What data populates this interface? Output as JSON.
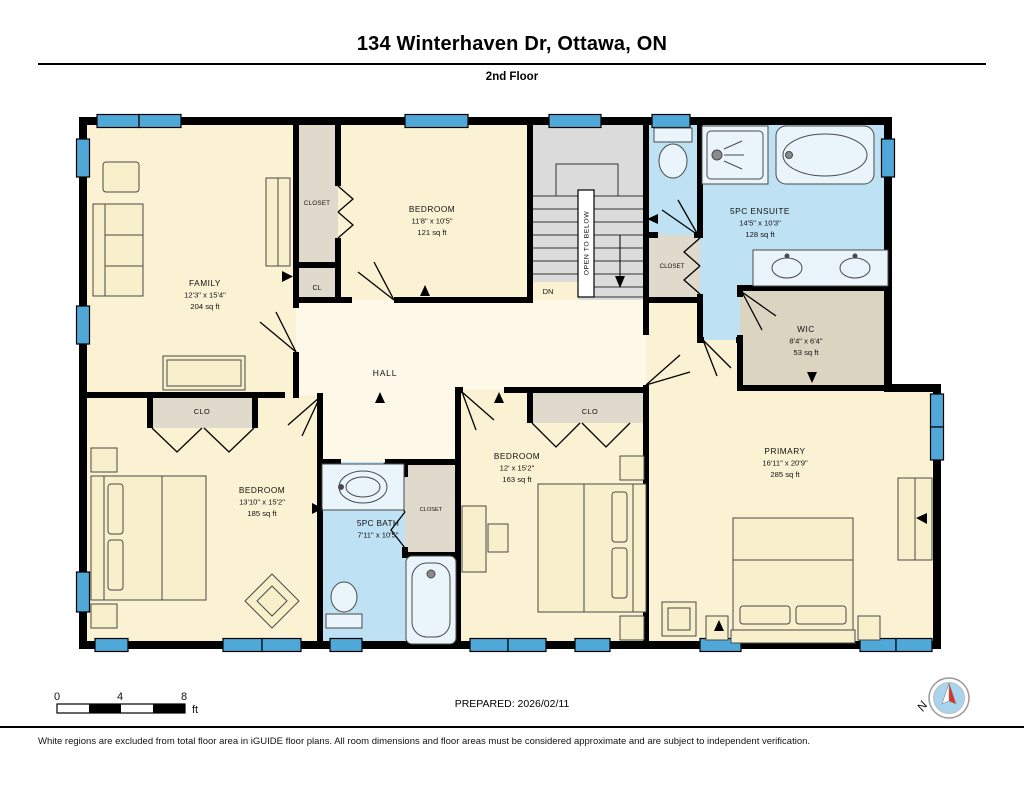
{
  "header": {
    "title": "134 Winterhaven Dr, Ottawa, ON",
    "floor": "2nd Floor"
  },
  "rooms": {
    "family": {
      "name": "FAMILY",
      "dims": "12'3\" x 15'4\"",
      "area": "204 sq ft"
    },
    "closet_top": {
      "name": "CLOSET"
    },
    "cl": {
      "name": "CL"
    },
    "bedroom_top": {
      "name": "BEDROOM",
      "dims": "11'8\" x 10'5\"",
      "area": "121 sq ft"
    },
    "stairs": {
      "open_to_below": "OPEN TO BELOW",
      "dn": "DN"
    },
    "closet_mid": {
      "name": "CLOSET"
    },
    "ensuite": {
      "name": "5PC ENSUITE",
      "dims": "14'5\" x 10'3\"",
      "area": "128 sq ft"
    },
    "wic": {
      "name": "WIC",
      "dims": "8'4\" x 6'4\"",
      "area": "53 sq ft"
    },
    "hall": {
      "name": "HALL"
    },
    "clo_left": {
      "name": "CLO"
    },
    "clo_right": {
      "name": "CLO"
    },
    "bedroom_left": {
      "name": "BEDROOM",
      "dims": "13'10\" x 15'2\"",
      "area": "185 sq ft"
    },
    "bath": {
      "name": "5PC BATH",
      "dims": "7'11\" x 10'5\""
    },
    "closet_bath": {
      "name": "CLOSET"
    },
    "bedroom_mid": {
      "name": "BEDROOM",
      "dims": "12' x 15'2\"",
      "area": "163 sq ft"
    },
    "primary": {
      "name": "PRIMARY",
      "dims": "16'11\" x 20'9\"",
      "area": "285 sq ft"
    }
  },
  "footer": {
    "scale": {
      "t0": "0",
      "t4": "4",
      "t8": "8",
      "unit": "ft"
    },
    "prepared": "PREPARED: 2026/02/11",
    "compass_n": "N",
    "disclaimer": "White regions are excluded from total floor area in iGUIDE floor plans. All room dimensions and floor areas must be considered approximate and are subject to independent verification."
  },
  "colors": {
    "room_cream": "#FBF2D3",
    "hall_cream": "#FDF8E7",
    "bath_blue": "#BEE1F4",
    "window_blue": "#4FA8D8",
    "closet_gray": "#DFDACB",
    "wic_tan": "#DBD4C1",
    "stairs_gray": "#DBDBDB",
    "wall_black": "#000000",
    "compass_red": "#E03020"
  }
}
